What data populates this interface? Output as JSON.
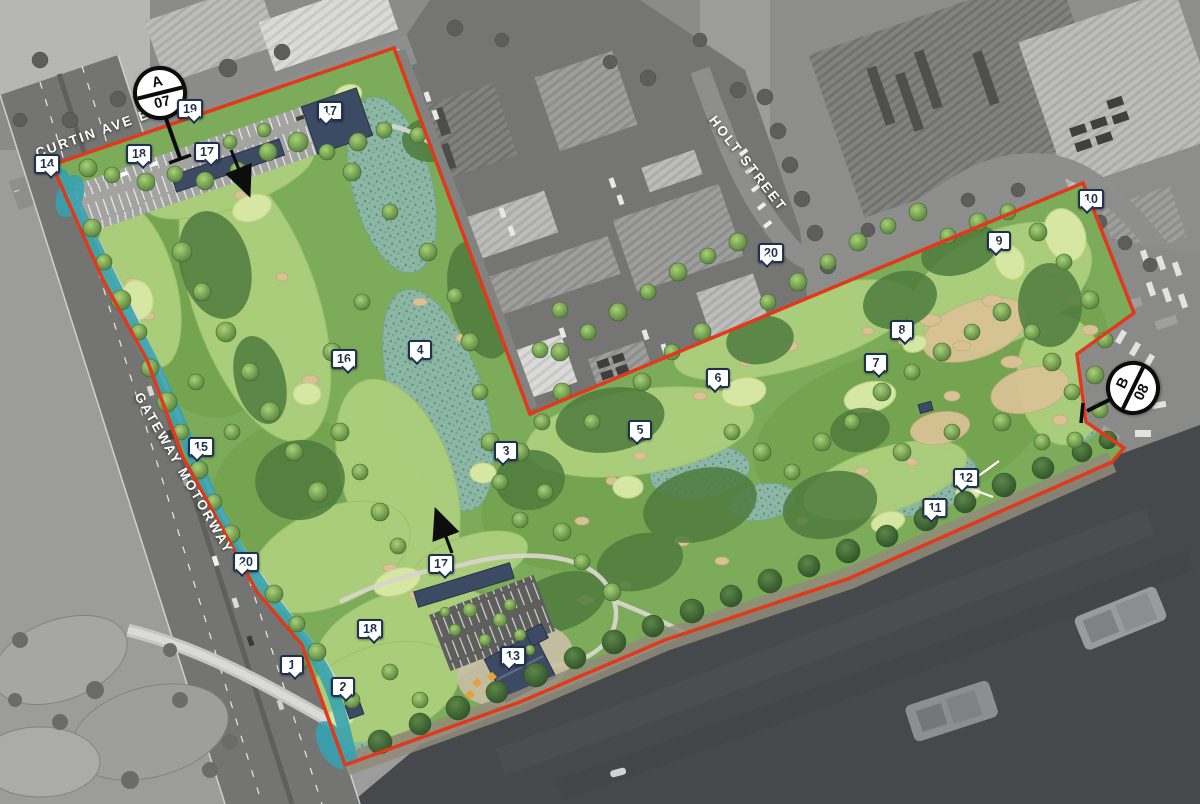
{
  "plan": {
    "streets": {
      "curtin": "CURTIN AVE E",
      "holt": "HOLT STREET",
      "gateway": "GATEWAY MOTORWAY"
    },
    "section_markers": [
      {
        "letter": "A",
        "number": "07"
      },
      {
        "letter": "B",
        "number": "08"
      }
    ],
    "callouts": [
      {
        "label": "1",
        "x": 292,
        "y": 666,
        "tail": "br"
      },
      {
        "label": "2",
        "x": 343,
        "y": 688,
        "tail": "br"
      },
      {
        "label": "3",
        "x": 506,
        "y": 452,
        "tail": "bl"
      },
      {
        "label": "4",
        "x": 420,
        "y": 351,
        "tail": "bl"
      },
      {
        "label": "5",
        "x": 640,
        "y": 431,
        "tail": "bl"
      },
      {
        "label": "6",
        "x": 718,
        "y": 379,
        "tail": "bl"
      },
      {
        "label": "7",
        "x": 876,
        "y": 364,
        "tail": "br"
      },
      {
        "label": "8",
        "x": 902,
        "y": 331,
        "tail": "br"
      },
      {
        "label": "9",
        "x": 999,
        "y": 242,
        "tail": "bl"
      },
      {
        "label": "10",
        "x": 1091,
        "y": 200,
        "tail": "bl"
      },
      {
        "label": "11",
        "x": 935,
        "y": 509,
        "tail": "bl"
      },
      {
        "label": "12",
        "x": 966,
        "y": 479,
        "tail": "bl"
      },
      {
        "label": "13",
        "x": 513,
        "y": 657,
        "tail": "bl"
      },
      {
        "label": "14",
        "x": 47,
        "y": 165,
        "tail": "br"
      },
      {
        "label": "15",
        "x": 201,
        "y": 448,
        "tail": "bl"
      },
      {
        "label": "16",
        "x": 344,
        "y": 360,
        "tail": "br"
      },
      {
        "label": "17",
        "x": 207,
        "y": 153,
        "tail": "br"
      },
      {
        "label": "17",
        "x": 330,
        "y": 112,
        "tail": "bl"
      },
      {
        "label": "17",
        "x": 441,
        "y": 565,
        "tail": "br"
      },
      {
        "label": "18",
        "x": 139,
        "y": 155,
        "tail": "br"
      },
      {
        "label": "18",
        "x": 370,
        "y": 630,
        "tail": "br"
      },
      {
        "label": "19",
        "x": 190,
        "y": 110,
        "tail": "br"
      },
      {
        "label": "20",
        "x": 246,
        "y": 563,
        "tail": "bl"
      },
      {
        "label": "20",
        "x": 771,
        "y": 254,
        "tail": "bl"
      }
    ],
    "colors": {
      "boundary": "#e2381c",
      "water_channel": "#35a2b1",
      "tag_border": "#1e3050",
      "building": "#3c4a63"
    }
  }
}
